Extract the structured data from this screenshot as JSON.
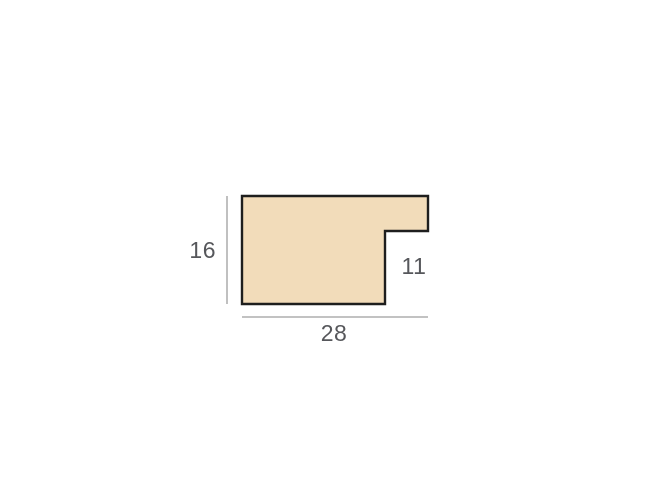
{
  "diagram": {
    "type": "moulding-profile-cross-section",
    "labels": {
      "height": "16",
      "width": "28",
      "rebate": "11"
    },
    "values": {
      "height": 16,
      "width": 28,
      "rebate": 11
    },
    "colors": {
      "background": "#ffffff",
      "profile_fill": "#f2dcba",
      "profile_outline": "#1e1e1e",
      "dimension_line": "#9e9e9e",
      "label_text": "#56575b"
    }
  }
}
